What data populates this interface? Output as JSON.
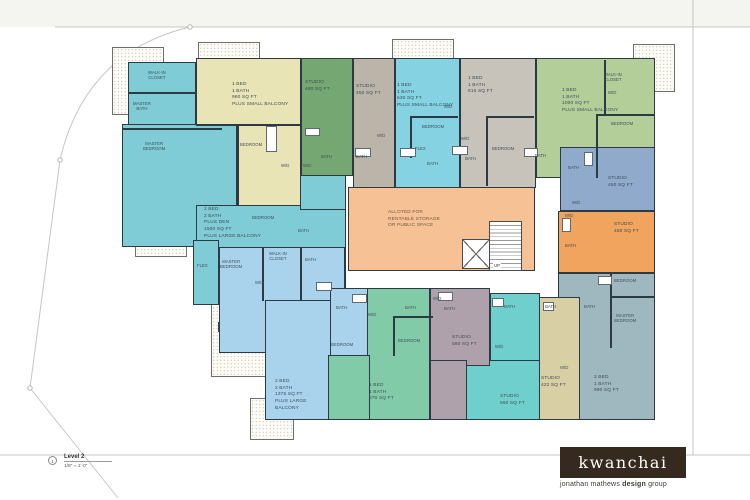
{
  "sheet": {
    "title_marker": "1",
    "level_label": "Level 2",
    "scale_label": "1/8\" = 1'-0\"",
    "center_label": "ALLOTED FOR\nRENTABLE STORAGE\nOR PUBLIC SPACE",
    "center_color": "#f6c195",
    "stair_label": "UP",
    "wall_color": "#2c3a43"
  },
  "logo": {
    "brand": "kwanchai",
    "bg_color": "#36291e",
    "tagline_pre": "jonathan mathews ",
    "tagline_bold": "design",
    "tagline_post": " group"
  },
  "units": [
    {
      "id": "2bed-1500",
      "label": "2 BED\n2 BATH\nPLUS DEN\n1500 SQ FT\nPLUS LARGE BALCONY",
      "color": "#7fcbd6",
      "rooms": [
        "WALK-IN\nCLOSET",
        "MASTER\nBATH",
        "MASTER\nBEDROOM",
        "BEDROOM",
        "BATH",
        "FLEX"
      ]
    },
    {
      "id": "1bed-960",
      "label": "1 BED\n1 BATH\n960 SQ FT\nPLUS SMALL BALCONY",
      "color": "#e9e4b5",
      "rooms": [
        "BEDROOM",
        "W/D"
      ]
    },
    {
      "id": "studio-480",
      "label": "STUDIO\n480 SQ FT",
      "color": "#74a771",
      "rooms": [
        "BATH",
        "W/D"
      ]
    },
    {
      "id": "studio-450-top",
      "label": "STUDIO\n450 SQ FT",
      "color": "#bbb5a9",
      "rooms": [
        "W/D",
        "BATH"
      ]
    },
    {
      "id": "1bed-630",
      "label": "1 BED\n1 BATH\n630 SQ FT\nPLUS SMALL BALCONY",
      "color": "#84d2e2",
      "rooms": [
        "W/D",
        "BEDROOM",
        "FLEX",
        "BATH"
      ]
    },
    {
      "id": "1bed-615",
      "label": "1 BED\n1 BATH\n615 SQ FT",
      "color": "#c7c3bb",
      "rooms": [
        "W/D",
        "BATH",
        "BEDROOM"
      ]
    },
    {
      "id": "1bed-1000",
      "label": "1 BED\n1 BATH\n1000 SQ FT\nPLUS SMALL BALCONY",
      "color": "#b4ce9a",
      "rooms": [
        "WALK-IN\nCLOSET",
        "W/D",
        "BEDROOM",
        "BATH"
      ]
    },
    {
      "id": "studio-450-blue",
      "label": "STUDIO\n450 SQ FT",
      "color": "#8faacb",
      "rooms": [
        "BATH",
        "W/D"
      ]
    },
    {
      "id": "studio-450-orange",
      "label": "STUDIO\n450 SQ FT",
      "color": "#f0a45d",
      "rooms": [
        "W/D",
        "BATH"
      ]
    },
    {
      "id": "2bed-990",
      "label": "2 BED\n1 BATH\n990 SQ FT",
      "color": "#9fb8bf",
      "rooms": [
        "BEDROOM",
        "MASTER\nBEDROOM",
        "BATH"
      ]
    },
    {
      "id": "studio-422",
      "label": "STUDIO\n422 SQ FT",
      "color": "#d8cfa4",
      "rooms": [
        "BATH",
        "W/D"
      ]
    },
    {
      "id": "studio-560-teal",
      "label": "STUDIO\n560 SQ FT",
      "color": "#6fcfcd",
      "rooms": [
        "BATH",
        "W/D"
      ]
    },
    {
      "id": "studio-560-mauve",
      "label": "STUDIO\n560 SQ FT",
      "color": "#afa1ab",
      "rooms": [
        "W/D",
        "BATH"
      ]
    },
    {
      "id": "1bed-870",
      "label": "1 BED\n1 BATH\n870 SQ FT",
      "color": "#82cba9",
      "rooms": [
        "W/D",
        "BATH",
        "BEDROOM"
      ]
    },
    {
      "id": "2bed-1375",
      "label": "2 BED\n2 BATH\n1375 SQ FT\nPLUS LARGE BALCONY",
      "color": "#a9d3ec",
      "rooms": [
        "MASTER\nBEDROOM",
        "WALK-IN\nCLOSET",
        "BATH",
        "W/D",
        "BATH",
        "BEDROOM"
      ]
    }
  ]
}
